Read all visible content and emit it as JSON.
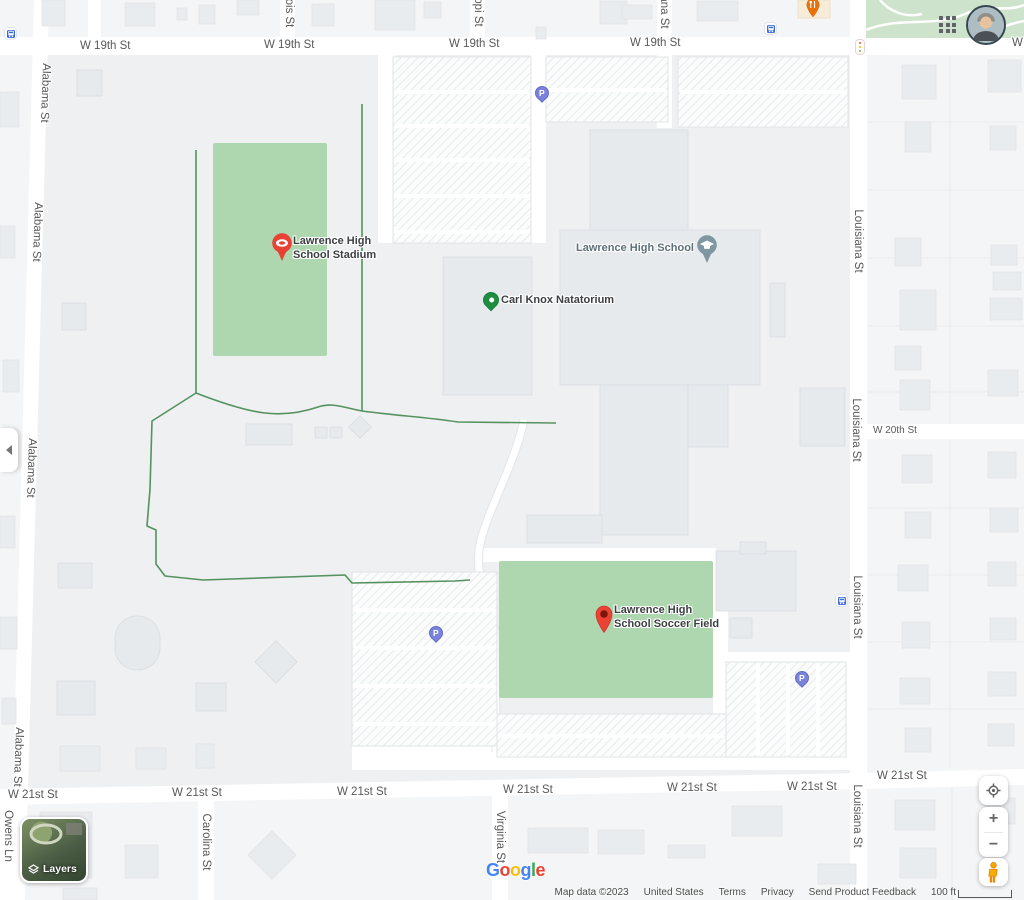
{
  "map": {
    "streets": {
      "w19th": "W 19th St",
      "w20th": "W 20th St",
      "w21st": "W 21st St",
      "alabama": "Alabama St",
      "louisiana": "Louisiana St",
      "carolina": "Carolina St",
      "virginia": "Virginia St",
      "owens": "Owens Ln",
      "illinois_part": "ois St",
      "mississippi_part": "ppi St",
      "indiana_part": "ana St"
    },
    "pois": {
      "stadium_line1": "Lawrence High",
      "stadium_line2": "School Stadium",
      "natatorium": "Carl Knox Natatorium",
      "school": "Lawrence High School",
      "soccer_line1": "Lawrence High",
      "soccer_line2": "School Soccer Field"
    },
    "markers": {
      "parking_letter": "P"
    },
    "colors": {
      "poi_red": "#EA4335",
      "poi_green": "#1E8E3E",
      "poi_school_gray": "#8097A1",
      "parking_purple": "#7B82D9",
      "field_green": "#AED6AF",
      "park_green": "#CEE3CC",
      "trail_green": "#55925F",
      "transit_blue": "#3B6DD8",
      "road_white": "#FFFFFF"
    }
  },
  "controls": {
    "layers_label": "Layers",
    "zoom_in_label": "+",
    "zoom_out_label": "−"
  },
  "attribution": {
    "logo_letters": [
      "G",
      "o",
      "o",
      "g",
      "l",
      "e"
    ],
    "map_data": "Map data ©2023",
    "region": "United States",
    "terms": "Terms",
    "privacy": "Privacy",
    "feedback": "Send Product Feedback",
    "scale_label": "100 ft"
  }
}
